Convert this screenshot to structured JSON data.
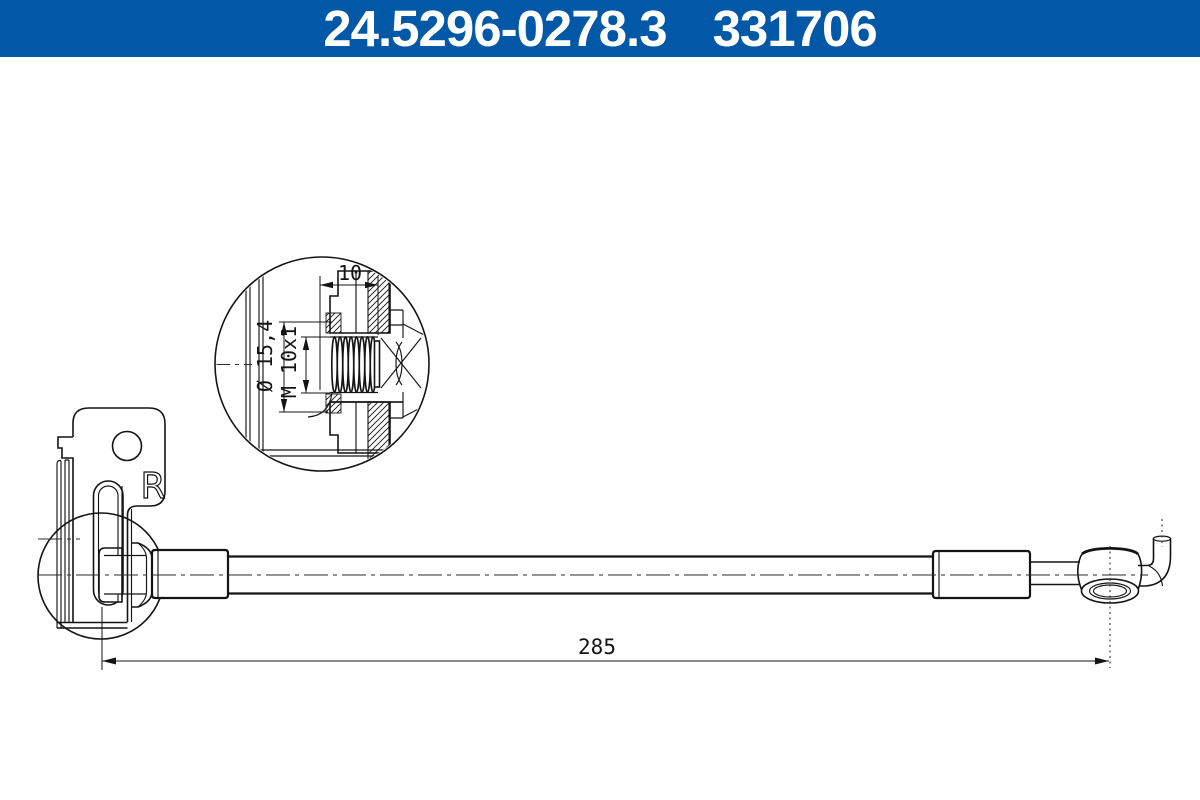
{
  "header": {
    "part_number": "24.5296-0278.3",
    "article_number": "331706"
  },
  "detail_view": {
    "thread_length_label": "10",
    "outer_diameter_label": "Ø 15,4",
    "thread_spec_label": "M 10x1"
  },
  "bracket": {
    "side_marking": "R"
  },
  "dimensions": {
    "overall_length_label": "285"
  },
  "colors": {
    "header_background": "#0058A6",
    "header_text": "#FFFFFF",
    "line_color": "#141414",
    "drawing_background": "#FFFFFF"
  }
}
